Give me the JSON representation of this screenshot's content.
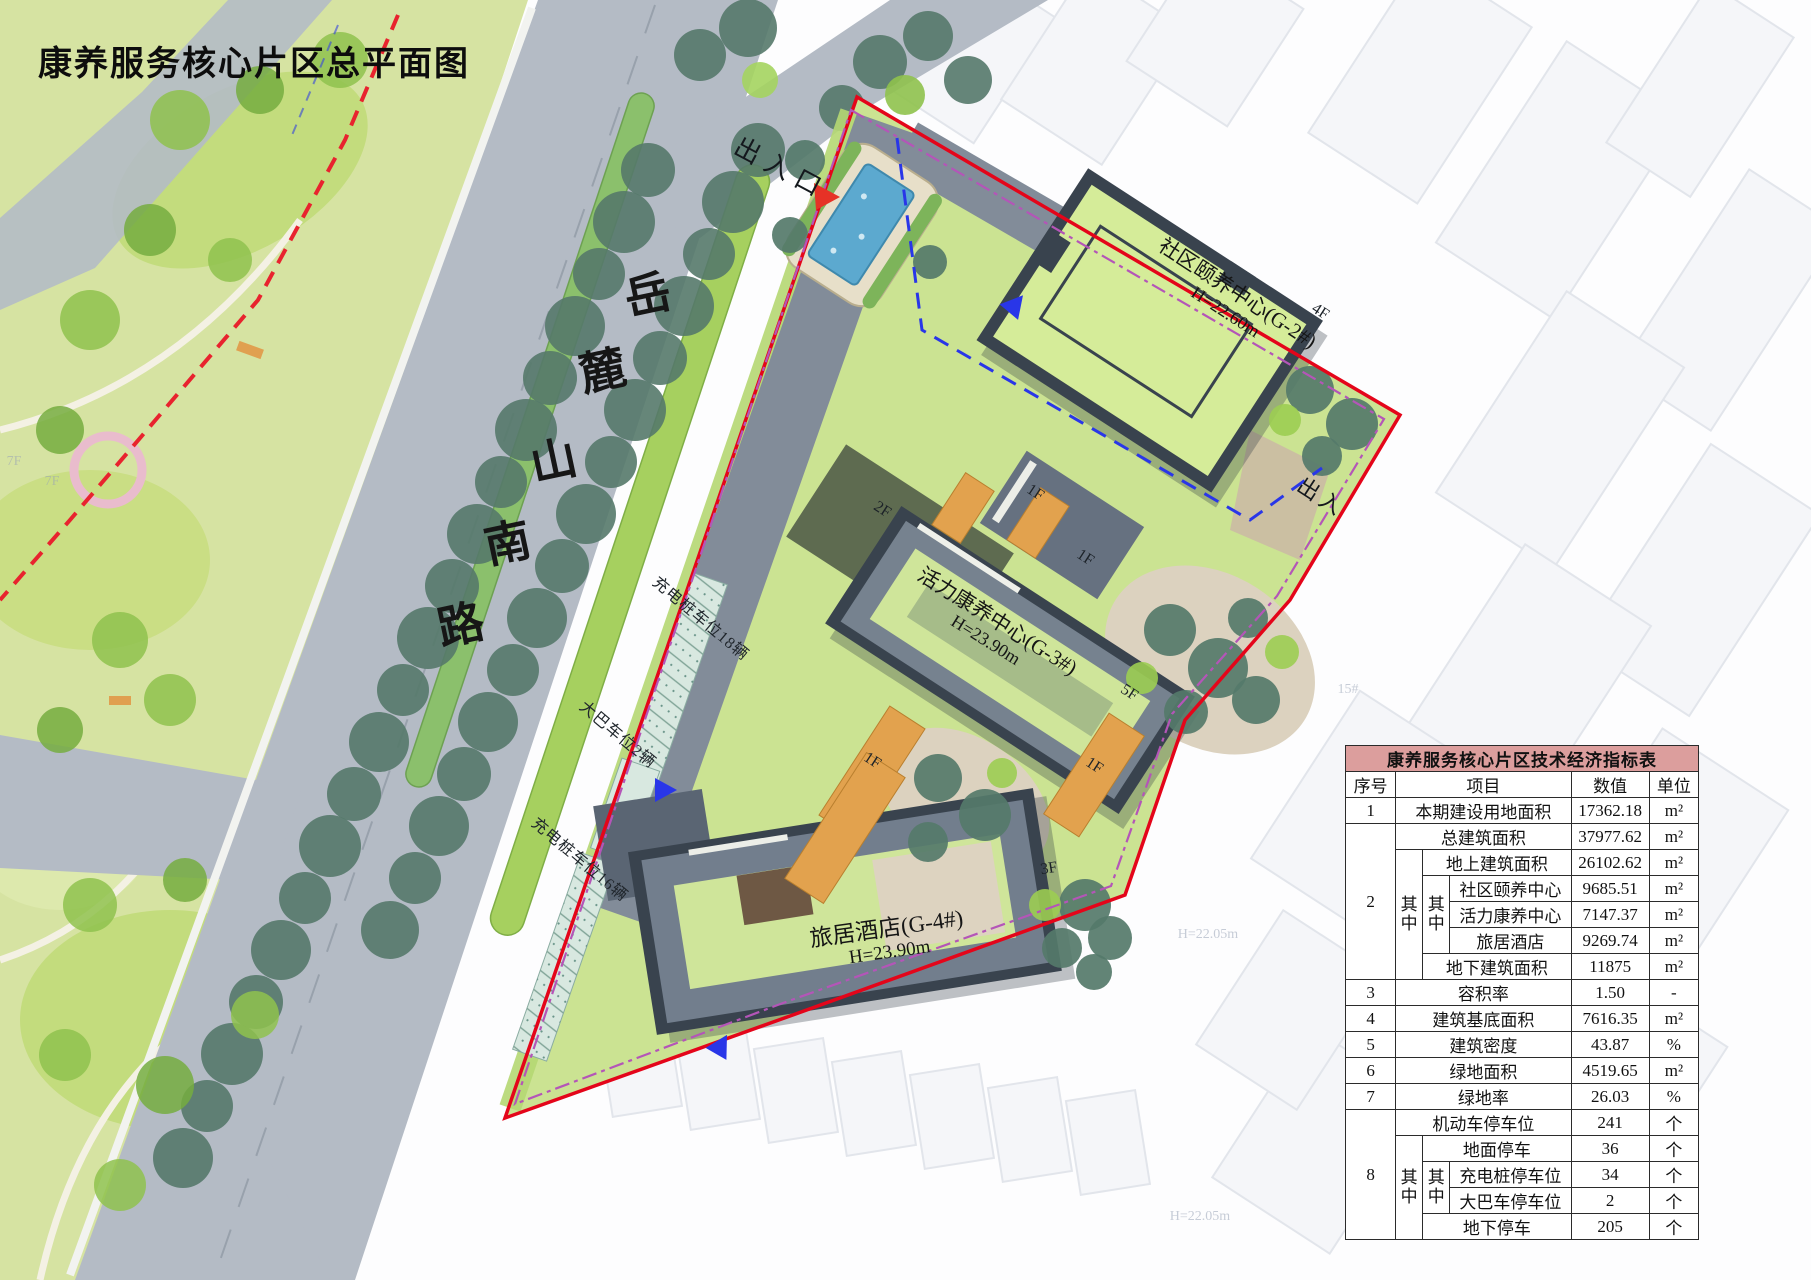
{
  "page": {
    "title": "康养服务核心片区总平面图"
  },
  "map": {
    "road_chars": [
      "岳",
      "麓",
      "山",
      "南",
      "路"
    ],
    "entrance_top": "出入口",
    "entrance_right": "出入",
    "parking": {
      "charging18": "充电桩车位18辆",
      "bus2": "大巴车位2辆",
      "charging16": "充电桩车位16辆"
    },
    "buildings": {
      "g2": {
        "name": "社区颐养中心(G-2#)",
        "height": "H=22.60m",
        "floors": "4F"
      },
      "g3": {
        "name": "活力康养中心(G-3#)",
        "height": "H=23.90m",
        "floors": "5F"
      },
      "g4": {
        "name": "旅居酒店(G-4#)",
        "height": "H=23.90m",
        "floors": "3F"
      }
    },
    "floor_tags": [
      "1F",
      "1F",
      "2F",
      "1F",
      "1F"
    ],
    "ghost_labels": [
      "7F",
      "7F",
      "H=22.05m",
      "H=22.05m",
      "15#"
    ]
  },
  "table": {
    "title": "康养服务核心片区技术经济指标表",
    "col_no": "序号",
    "col_item": "项目",
    "col_value": "数值",
    "col_unit": "单位",
    "qizhong": "其中",
    "unit_m2": "m²",
    "unit_pct": "%",
    "unit_ge": "个",
    "unit_dash": "-",
    "rows": {
      "r1": {
        "no": "1",
        "item": "本期建设用地面积",
        "value": "17362.18"
      },
      "r2": {
        "no": "2",
        "item": "总建筑面积",
        "value": "37977.62"
      },
      "r2a": {
        "item": "地上建筑面积",
        "value": "26102.62"
      },
      "r2a1": {
        "item": "社区颐养中心",
        "value": "9685.51"
      },
      "r2a2": {
        "item": "活力康养中心",
        "value": "7147.37"
      },
      "r2a3": {
        "item": "旅居酒店",
        "value": "9269.74"
      },
      "r2b": {
        "item": "地下建筑面积",
        "value": "11875"
      },
      "r3": {
        "no": "3",
        "item": "容积率",
        "value": "1.50"
      },
      "r4": {
        "no": "4",
        "item": "建筑基底面积",
        "value": "7616.35"
      },
      "r5": {
        "no": "5",
        "item": "建筑密度",
        "value": "43.87"
      },
      "r6": {
        "no": "6",
        "item": "绿地面积",
        "value": "4519.65"
      },
      "r7": {
        "no": "7",
        "item": "绿地率",
        "value": "26.03"
      },
      "r8": {
        "no": "8",
        "item": "机动车停车位",
        "value": "241"
      },
      "r8a": {
        "item": "地面停车",
        "value": "36"
      },
      "r8a1": {
        "item": "充电桩停车位",
        "value": "34"
      },
      "r8a2": {
        "item": "大巴车停车位",
        "value": "2"
      },
      "r8b": {
        "item": "地下停车",
        "value": "205"
      }
    }
  }
}
